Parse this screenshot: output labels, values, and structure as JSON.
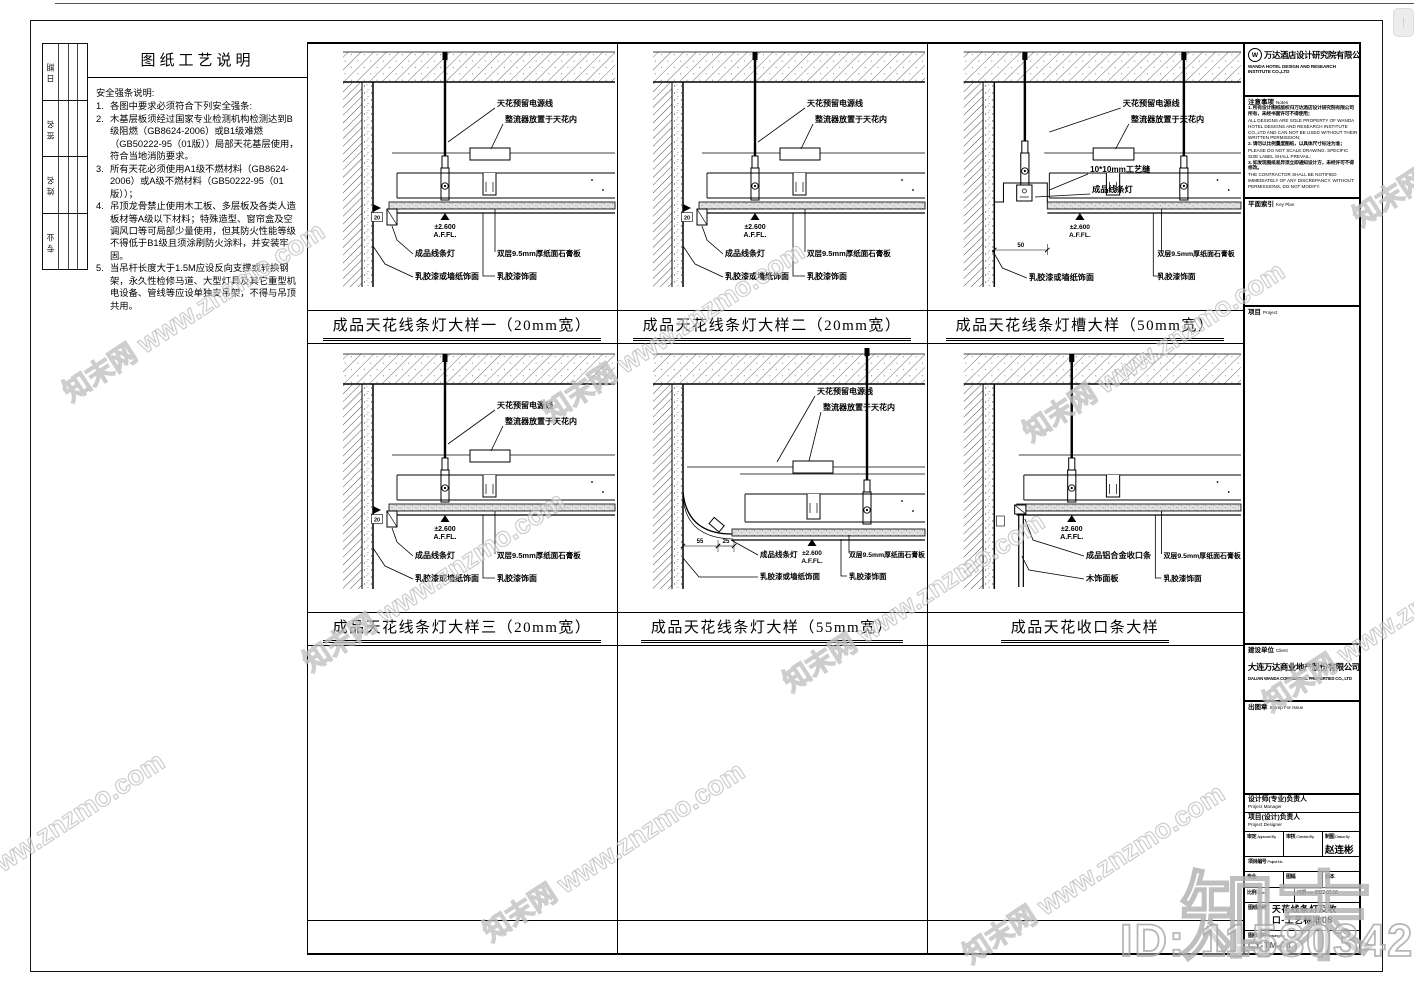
{
  "watermark": {
    "tile_text": "知末网 www.znzmo.com",
    "logo_text": "知末",
    "id_text": "ID: 1158034221"
  },
  "signoff": {
    "rows": [
      "日期",
      "签名",
      "姓名",
      "专业"
    ]
  },
  "process_notes": {
    "title": "图纸工艺说明",
    "subtitle": "安全强条说明:",
    "items": [
      "各图中要求必须符合下列安全强条:",
      "木基层板须经过国家专业检测机构检测达到B级阻燃（GB8624-2006）或B1级难燃（GB50222-95（01版））局部天花基层使用，符合当地消防要求。",
      "所有天花必须使用A1级不燃材料（GB8624-2006）或A级不燃材料（GB50222-95（01版））；",
      "吊顶龙骨禁止使用木工板、多层板及各类人造板材等A级以下材料；特殊造型、窗帘盒及空调风口等可局部少量使用，但其防火性能等级不得低于B1级且须涂刷防火涂料，并安装牢固。",
      "当吊杆长度大于1.5M应设反向支撑或转换钢架，永久性检修马道、大型灯具及其它重型机电设备、管线等应设单独支吊架，不得与吊顶共用。"
    ]
  },
  "details": [
    {
      "variant": "basic",
      "title": "成品天花线条灯大样一（20mm宽）",
      "dims": [
        "20"
      ],
      "level": {
        "value": "±2.600",
        "datum": "A.F.FL."
      },
      "labels": {
        "power": "天花预留电源线",
        "ballast": "整流器放置于天花内",
        "light": "成品线条灯",
        "wall": "乳胶漆或墙纸饰面",
        "board": "双层9.5mm厚纸面石膏板",
        "paint": "乳胶漆饰面"
      }
    },
    {
      "variant": "basic",
      "title": "成品天花线条灯大样二（20mm宽）",
      "dims": [
        "20"
      ],
      "level": {
        "value": "±2.600",
        "datum": "A.F.FL."
      },
      "labels": {
        "power": "天花预留电源线",
        "ballast": "整流器放置于天花内",
        "light": "成品线条灯",
        "wall": "乳胶漆或墙纸饰面",
        "board": "双层9.5mm厚纸面石膏板",
        "paint": "乳胶漆饰面"
      }
    },
    {
      "variant": "groove",
      "title": "成品天花线条灯槽大样（50mm宽）",
      "dims": [
        "50"
      ],
      "level": {
        "value": "±2.600",
        "datum": "A.F.FL."
      },
      "labels": {
        "power": "天花预留电源线",
        "ballast": "整流器放置于天花内",
        "groove": "10*10mm工艺缝",
        "light": "成品线条灯",
        "wall": "乳胶漆或墙纸饰面",
        "board": "双层9.5mm厚纸面石膏板",
        "paint": "乳胶漆饰面"
      }
    },
    {
      "variant": "basic",
      "title": "成品天花线条灯大样三（20mm宽）",
      "dims": [
        "20"
      ],
      "level": {
        "value": "±2.600",
        "datum": "A.F.FL."
      },
      "labels": {
        "power": "天花预留电源线",
        "ballast": "整流器放置于天花内",
        "light": "成品线条灯",
        "wall": "乳胶漆或墙纸饰面",
        "board": "双层9.5mm厚纸面石膏板",
        "paint": "乳胶漆饰面"
      }
    },
    {
      "variant": "cove",
      "title": "成品天花线条灯大样（55mm宽）",
      "dims": [
        "55",
        "25"
      ],
      "level": {
        "value": "±2.600",
        "datum": "A.F.FL."
      },
      "labels": {
        "power": "天花预留电源线",
        "ballast": "整流器放置于天花内",
        "light": "成品线条灯",
        "wall": "乳胶漆或墙纸饰面",
        "board": "双层9.5mm厚纸面石膏板",
        "paint": "乳胶漆饰面"
      }
    },
    {
      "variant": "trim",
      "title": "成品天花收口条大样",
      "dims": [],
      "level": {
        "value": "±2.600",
        "datum": "A.F.FL."
      },
      "labels": {
        "trim": "成品铝合金收口条",
        "wood": "木饰面板",
        "board": "双层9.5mm厚纸面石膏板",
        "paint": "乳胶漆饰面"
      }
    }
  ],
  "titleblock": {
    "company_cn": "万达酒店设计研究院有限公司",
    "company_en": "WANDA HOTEL DESIGN AND RESEARCH INSTITUTE CO.,LTD",
    "logo_letter": "W",
    "notes_label_cn": "注意事项",
    "notes_label_en": "Notes",
    "notes": [
      {
        "cn": "1. 所有设计图纸版权归万达酒店设计研究院有限公司所有，未经书面许可不得使用；",
        "en": "ALL DESIGNS ARE SOLE PROPERTY OF WANDA HOTEL DESIGNS AND RESEARCH INSTITUTE CO.,LTD AND CAN NOT BE USED WITHOUT THEIR WRITTEN PERMISSION;"
      },
      {
        "cn": "2. 请勿以比例量度图纸，以具体尺寸标注为准；",
        "en": "PLEASE DO NOT SCALE DRAWING. SPECIFIC SIZE LABEL SHALL PREVAIL;"
      },
      {
        "cn": "3. 如发现图纸差异须立即通知设计方，未经许可不得修改。",
        "en": "THE CONTRACTOR SHALL BE NOTIFIED IMMEDIATELY OF ANY DISCREPANCY. WITHOUT PERMISSIONS, DO NOT MODIFY."
      }
    ],
    "keyplan_cn": "平面索引",
    "keyplan_en": "Key Plan",
    "project_cn": "项目",
    "project_en": "Project",
    "client_cn": "建设单位",
    "client_en": "Client",
    "client_name_cn": "大连万达商业地产股份有限公司",
    "client_name_en": "DALIAN WANDA COMMERCIAL PROPERTIES CO., LTD",
    "stamp_cn": "出图章",
    "stamp_en": "Stamp For Issue",
    "pm_cn": "设计师(专业)负责人",
    "pm_en": "Project Manager",
    "pd_cn": "项目(设计)负责人",
    "pd_en": "Project Designer",
    "approved_cn": "审定",
    "approved_en": "Approved By",
    "checked_cn": "审核",
    "checked_en": "Checked By",
    "drawn_cn": "制图",
    "drawn_en": "Drawn By",
    "drawn_by": "赵连彬",
    "projno_cn": "项目编号",
    "projno_en": "Project No.",
    "meta1": [
      {
        "cn": "专业",
        "en": "Speciality"
      },
      {
        "cn": "图幅",
        "en": "Size"
      },
      {
        "cn": "版本",
        "en": "Issue"
      }
    ],
    "scale_cn": "比例",
    "scale_en": "Scale",
    "date_cn": "日期",
    "date_en": "Date",
    "date_value": "2022.02.16",
    "dtitle_cn": "图纸名称",
    "dtitle_en": "Title",
    "drawing_title_line1": "天花线条灯及收",
    "drawing_title_line2": "口-工艺标准08",
    "dno_cn": "图纸编号",
    "dno_en": "Drawing No.",
    "drawing_no": "CY-TM-08"
  }
}
